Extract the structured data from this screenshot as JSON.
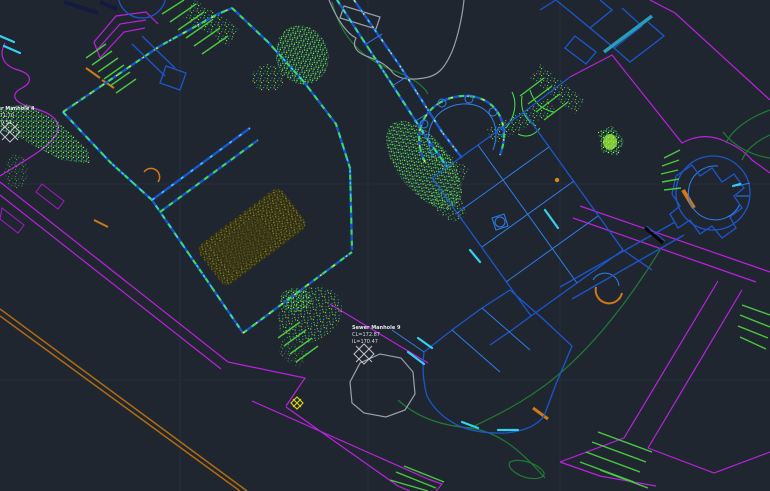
{
  "viewport": {
    "type": "cad-site-plan-viewport",
    "background": "#1f2630",
    "grid_color": "#2a3240"
  },
  "palette": {
    "road_magenta": "#bb22dd",
    "building_blue": "#1d56cc",
    "building_blue_light": "#2f7fe8",
    "wall_teal": "#2a9db8",
    "accent_cyan": "#35d0f0",
    "pointcloud_green": "#3ade52",
    "hatch_lime": "#49c93f",
    "contour_green": "#227a33",
    "garden_olive": "#8a7a28",
    "fence_orange": "#b06c12",
    "accent_orange": "#cc7a1a",
    "canopy_gray": "#99a1aa",
    "marker_yellow": "#d8d020",
    "annotation_text": "#d6dade"
  },
  "labels": {
    "manhole9": {
      "name": "Sewer Manhole 9",
      "cover_level": "CL=172.87",
      "invert_level": "IL=170.47"
    },
    "manhole4": {
      "name": "Sewer Manhole 4",
      "cover_level": "CL=171.70",
      "invert_level": "IL=170.51"
    }
  }
}
